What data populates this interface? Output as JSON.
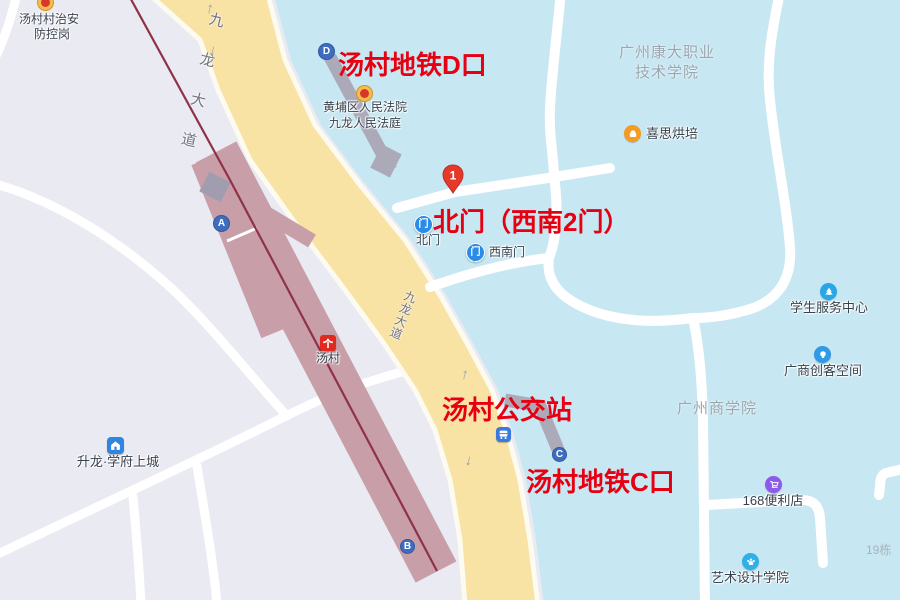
{
  "annotations": {
    "exit_d": "汤村地铁D口",
    "north_gate": "北门（西南2门）",
    "bus_station": "汤村公交站",
    "exit_c": "汤村地铁C口",
    "pin_number": "1"
  },
  "roads": {
    "top_label": "九龙大道",
    "mid_label": "九龙大道"
  },
  "metro": {
    "station_name": "汤村",
    "exits": {
      "a": "A",
      "b": "B",
      "c": "C",
      "d": "D"
    }
  },
  "gates": {
    "north": {
      "label": "北门"
    },
    "southwest": {
      "label": "西南门"
    }
  },
  "pois": {
    "security_post": {
      "line1": "汤村村治安",
      "line2": "防控岗"
    },
    "court": {
      "line1": "黄埔区人民法院",
      "line2": "九龙人民法庭"
    },
    "kangda_college": {
      "line1": "广州康大职业",
      "line2": "技术学院"
    },
    "bakery": {
      "label": "喜思烘培"
    },
    "student_service": {
      "label": "学生服务中心"
    },
    "maker_space": {
      "label": "广商创客空间"
    },
    "commerce_college": {
      "label": "广州商学院"
    },
    "store_168": {
      "label": "168便利店"
    },
    "art_college": {
      "label": "艺术设计学院"
    },
    "shenglong_estate": {
      "label": "升龙·学府上城"
    },
    "building_19": {
      "label": "19栋"
    }
  },
  "icons": {
    "arrow_up": "↑",
    "arrow_down": "↓",
    "gate_glyph": "门"
  },
  "colors": {
    "annotation_red": "#e60012",
    "campus_blue": "#c7e7f2",
    "road_yellow": "#f8e2a4",
    "ground_gray": "#eaeaf2",
    "station_mauve": "#c89fa8",
    "metro_line": "#8f3247",
    "exit_corridor_gray": "#aca9b8",
    "exit_pin_blue": "#3e6dbe",
    "gate_pin_blue": "#2b8ce8",
    "pin_red": "#e33a2b"
  }
}
